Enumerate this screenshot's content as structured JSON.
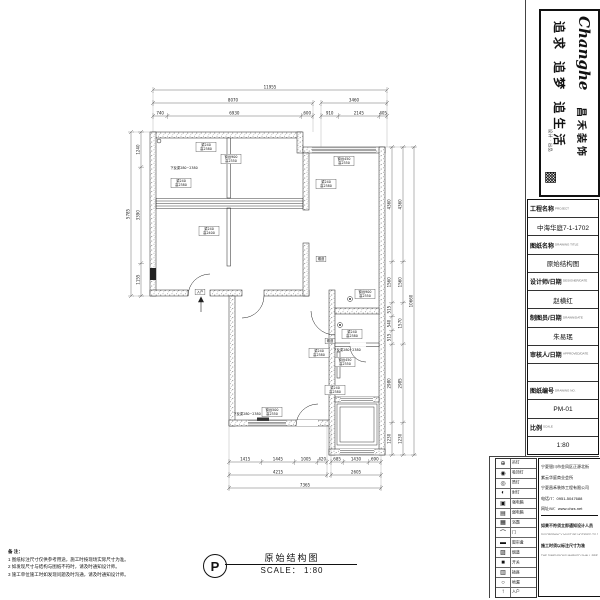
{
  "logo": {
    "brand": "Changhe",
    "brand_cn": "昌禾装饰",
    "slogan": "追求 追梦 追生活",
    "seal": "设计 · 出品",
    "qr_glyph": "▩"
  },
  "title_block": {
    "rows": [
      {
        "type": "label",
        "cn": "工程名称",
        "en": "PROJECT"
      },
      {
        "type": "value",
        "cn": "中海华庭7-1-1702"
      },
      {
        "type": "label",
        "cn": "图纸名称",
        "en": "DRAWING TITLE"
      },
      {
        "type": "value",
        "cn": "原始结构图"
      },
      {
        "type": "label",
        "cn": "设计师/日期",
        "en": "DESIGNER/DATE"
      },
      {
        "type": "value",
        "cn": "赵横红"
      },
      {
        "type": "label",
        "cn": "制图员/日期",
        "en": "DRAWN/DATE"
      },
      {
        "type": "value",
        "cn": "朱易珉"
      },
      {
        "type": "label",
        "cn": "审核人/日期",
        "en": "APPROVED/DATE"
      },
      {
        "type": "value",
        "cn": ""
      },
      {
        "type": "label",
        "cn": "图纸编号",
        "en": "DRAWING NO."
      },
      {
        "type": "value",
        "cn": "PM-01"
      },
      {
        "type": "label",
        "cn": "比例",
        "en": "SCALE"
      },
      {
        "type": "value",
        "cn": "1:80"
      }
    ]
  },
  "legend": {
    "items": [
      {
        "symbol": "⊕",
        "label": "吊灯"
      },
      {
        "symbol": "◉",
        "label": "吸顶灯"
      },
      {
        "symbol": "◎",
        "label": "筒灯"
      },
      {
        "symbol": "◐",
        "label": "射灯"
      },
      {
        "symbol": "▣",
        "label": "强电箱"
      },
      {
        "symbol": "▤",
        "label": "弱电箱"
      },
      {
        "symbol": "▦",
        "label": "浴霸"
      },
      {
        "symbol": "⌒",
        "label": "门"
      },
      {
        "symbol": "▬",
        "label": "窗帘盒"
      },
      {
        "symbol": "▨",
        "label": "烟道"
      },
      {
        "symbol": "■",
        "label": "开关"
      },
      {
        "symbol": "▥",
        "label": "插座"
      },
      {
        "symbol": "○",
        "label": "地漏"
      },
      {
        "symbol": "↑",
        "label": "入户"
      }
    ]
  },
  "company": {
    "address_lines": [
      "宁夏银川市金凤区正源北街",
      "紫云华庭商业会所",
      "宁夏昌禾装饰工程有限公司",
      "电话/T：0951-5047688",
      "网址/W：www.chzs.net"
    ],
    "notices": [
      {
        "cn": "如果不符须立即通知设计人员",
        "en": "DISCREPANCY MUST BE NOTIFIED TO THE DESIGNER IN TIME"
      },
      {
        "cn": "施工时须以标注尺寸为准",
        "en": "THE DIMENSIONS MARKED SHALL PREVAIL"
      }
    ]
  },
  "notes": {
    "title": "备 注：",
    "items": [
      "1 图纸标注尺寸仅供参考用途，施工时按现场实际尺寸为准。",
      "2 如发现尺寸与结构与图纸不符时，请及时通知设计师。",
      "3 施工单位施工时如发现问题及时沟通，请及时通知设计师。"
    ]
  },
  "plan_title": {
    "marker": "P",
    "name": "原始结构图",
    "scale": "SCALE： 1:80"
  },
  "dimensions": {
    "chains": [
      {
        "dir": "h",
        "x1": 153,
        "x2": 387,
        "y": 90,
        "segs": [
          "11955"
        ]
      },
      {
        "dir": "h",
        "x1": 153,
        "x2": 313,
        "y": 103,
        "segs": [
          "8070"
        ]
      },
      {
        "dir": "h",
        "x1": 321,
        "x2": 387,
        "y": 103,
        "segs": [
          "3460"
        ]
      },
      {
        "dir": "h",
        "x1": 153,
        "x2": 313,
        "y": 116,
        "segs": [
          "740",
          "6930",
          "600"
        ]
      },
      {
        "dir": "h",
        "x1": 321,
        "x2": 387,
        "y": 116,
        "segs": [
          "910",
          "2145",
          "405"
        ]
      },
      {
        "dir": "v",
        "x": 131,
        "y1": 132,
        "y2": 296,
        "segs": [
          "5785"
        ]
      },
      {
        "dir": "v",
        "x": 141,
        "y1": 132,
        "y2": 296,
        "segs": [
          "1240",
          "3390",
          "1155"
        ]
      },
      {
        "dir": "v",
        "x": 392,
        "y1": 147,
        "y2": 455,
        "segs": [
          "4360",
          "1560",
          "515",
          "540",
          "515",
          "2980",
          "1230"
        ]
      },
      {
        "dir": "v",
        "x": 403,
        "y1": 147,
        "y2": 455,
        "segs": [
          "4360",
          "1560",
          "1570",
          "2985",
          "1230"
        ]
      },
      {
        "dir": "v",
        "x": 414,
        "y1": 147,
        "y2": 455,
        "segs": [
          "10660"
        ]
      },
      {
        "dir": "h",
        "x1": 229,
        "x2": 327,
        "y": 462,
        "segs": [
          "1415",
          "1445",
          "1005",
          "420"
        ]
      },
      {
        "dir": "h",
        "x1": 331,
        "x2": 381,
        "y": 462,
        "segs": [
          "685",
          "1430",
          "690"
        ]
      },
      {
        "dir": "h",
        "x1": 229,
        "x2": 327,
        "y": 475,
        "segs": [
          "4215"
        ]
      },
      {
        "dir": "h",
        "x1": 331,
        "x2": 381,
        "y": 475,
        "segs": [
          "2605"
        ]
      },
      {
        "dir": "h",
        "x1": 229,
        "x2": 381,
        "y": 488,
        "segs": [
          "7365"
        ]
      }
    ]
  },
  "plan_labels": [
    {
      "x": 206,
      "y": 147,
      "box": true,
      "lines": [
        "梁240",
        "高2380"
      ]
    },
    {
      "x": 231,
      "y": 159,
      "box": true,
      "lines": [
        "窗台900",
        "高2350"
      ]
    },
    {
      "x": 344,
      "y": 161,
      "box": true,
      "lines": [
        "窗台450",
        "高2350"
      ]
    },
    {
      "x": 181,
      "y": 183,
      "box": true,
      "lines": [
        "梁240",
        "高2380"
      ]
    },
    {
      "x": 326,
      "y": 184,
      "box": true,
      "lines": [
        "梁240",
        "高2380"
      ]
    },
    {
      "x": 209,
      "y": 231,
      "box": true,
      "lines": [
        "梁240",
        "高2400"
      ]
    },
    {
      "x": 365,
      "y": 294,
      "box": true,
      "lines": [
        "窗台900",
        "高2350"
      ]
    },
    {
      "x": 352,
      "y": 334,
      "box": true,
      "lines": [
        "梁240",
        "高2380"
      ]
    },
    {
      "x": 330,
      "y": 341,
      "box": true,
      "lines": [
        "烟道"
      ]
    },
    {
      "x": 319,
      "y": 353,
      "box": true,
      "lines": [
        "梁240",
        "高2380"
      ]
    },
    {
      "x": 345,
      "y": 362,
      "box": true,
      "lines": [
        "窗台450",
        "高2350"
      ]
    },
    {
      "x": 335,
      "y": 390,
      "box": true,
      "lines": [
        "梁240",
        "高2380"
      ]
    },
    {
      "x": 272,
      "y": 412,
      "box": true,
      "lines": [
        "窗台500",
        "高2350"
      ]
    },
    {
      "x": 200,
      "y": 292,
      "box": true,
      "lines": [
        "入户"
      ]
    },
    {
      "x": 321,
      "y": 259,
      "box": true,
      "lines": [
        "烟道"
      ]
    },
    {
      "x": 184,
      "y": 168,
      "box": false,
      "lines": [
        "下反梁280~2380"
      ]
    },
    {
      "x": 347,
      "y": 350,
      "box": false,
      "lines": [
        "下反梁280~2380"
      ]
    },
    {
      "x": 247,
      "y": 414,
      "box": false,
      "lines": [
        "下反梁280~2380"
      ]
    }
  ],
  "colors": {
    "line": "#333",
    "wall_dot": "#949494",
    "text": "#111"
  }
}
